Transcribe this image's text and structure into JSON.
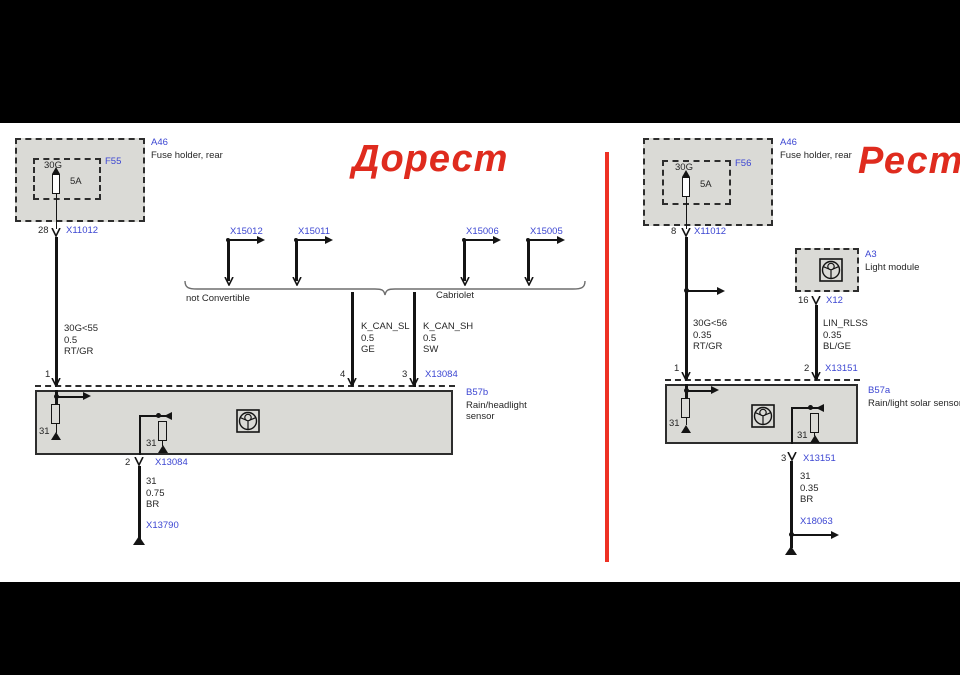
{
  "titles": {
    "left": "Дорест",
    "right": "Рест"
  },
  "colors": {
    "ref_blue": "#3c46d2",
    "title_red": "#df2b1e",
    "divider_red": "#ee3124",
    "box_fill": "#dadad6"
  },
  "left": {
    "fuse": {
      "holder_ref": "A46",
      "holder_desc": "Fuse holder, rear",
      "ref": "F55",
      "terminal": "30G",
      "rating": "5A",
      "out_pin": "28",
      "out_connector": "X11012"
    },
    "supply_wire": {
      "l1": "30G<55",
      "l2": "0.5",
      "l3": "RT/GR",
      "pin": "1"
    },
    "branch_connectors": [
      {
        "label": "X15012"
      },
      {
        "label": "X15011"
      },
      {
        "label": "X15006"
      },
      {
        "label": "X15005"
      }
    ],
    "variants": {
      "left": "not Convertible",
      "right": "Cabriolet"
    },
    "can_low": {
      "l1": "K_CAN_SL",
      "l2": "0.5",
      "l3": "GE",
      "pin": "4"
    },
    "can_high": {
      "l1": "K_CAN_SH",
      "l2": "0.5",
      "l3": "SW",
      "pin": "3",
      "connector": "X13084"
    },
    "sensor": {
      "ref": "B57b",
      "desc": "Rain/headlight sensor",
      "gnd1": "31",
      "gnd2": "31"
    },
    "ground_path": {
      "pin": "2",
      "connector": "X13084",
      "l1": "31",
      "l2": "0.75",
      "l3": "BR",
      "splice": "X13790"
    }
  },
  "right": {
    "fuse": {
      "holder_ref": "A46",
      "holder_desc": "Fuse holder, rear",
      "ref": "F56",
      "terminal": "30G",
      "rating": "5A",
      "out_pin": "8",
      "out_connector": "X11012"
    },
    "supply_wire": {
      "l1": "30G<56",
      "l2": "0.35",
      "l3": "RT/GR",
      "pin": "1"
    },
    "light_module": {
      "ref": "A3",
      "desc": "Light module",
      "out_pin": "16",
      "out_connector": "X12"
    },
    "lin_wire": {
      "l1": "LIN_RLSS",
      "l2": "0.35",
      "l3": "BL/GE",
      "pin": "2",
      "connector": "X13151"
    },
    "sensor": {
      "ref": "B57a",
      "desc": "Rain/light solar sensor",
      "gnd1": "31",
      "gnd2": "31"
    },
    "ground_path": {
      "pin": "3",
      "connector": "X13151",
      "l1": "31",
      "l2": "0.35",
      "l3": "BR",
      "splice": "X18063"
    }
  }
}
